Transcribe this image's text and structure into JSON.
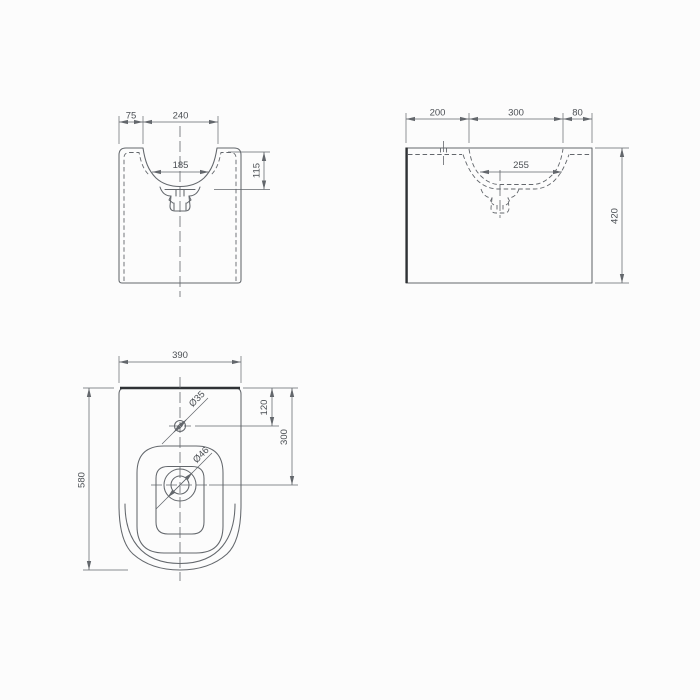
{
  "window": {
    "background": "#fcfcfc"
  },
  "drawing": {
    "colors": {
      "line": "#63676c",
      "thick_line": "#2f3235",
      "text": "#4b4f54"
    },
    "front_view": {
      "dims": {
        "left_deck": "75",
        "opening_width": "240",
        "bowl_floor_width": "185",
        "bowl_depth": "115"
      }
    },
    "side_view": {
      "dims": {
        "back_deck": "200",
        "opening_length": "300",
        "front_deck": "80",
        "bowl_floor_length": "255",
        "overall_height": "420"
      }
    },
    "plan_view": {
      "dims": {
        "overall_width": "390",
        "overall_depth": "580",
        "tap_hole_offset": "120",
        "drain_offset": "300",
        "tap_hole_diameter": "Ø35",
        "drain_diameter": "Ø46"
      }
    }
  }
}
